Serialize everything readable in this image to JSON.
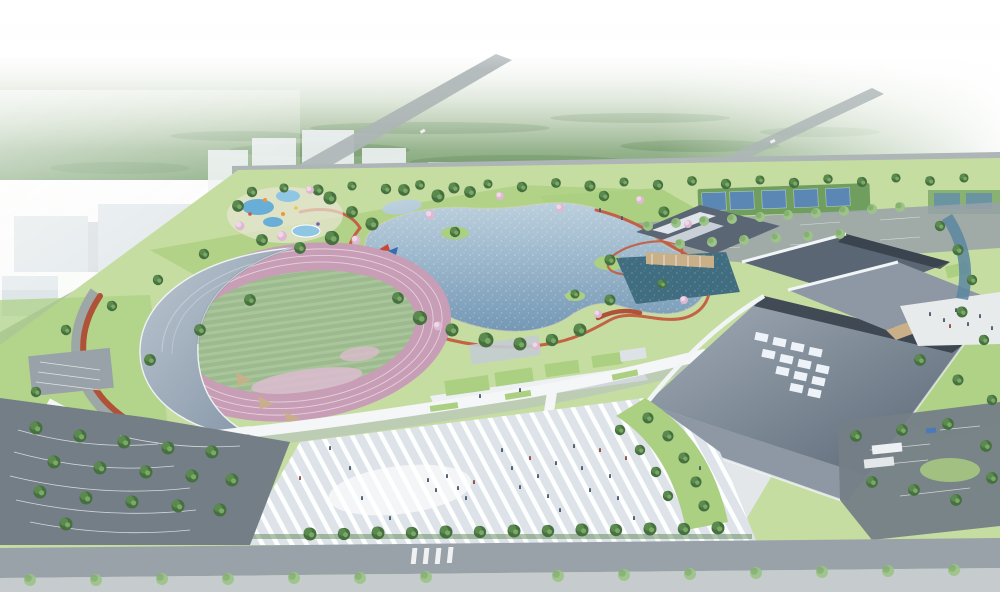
{
  "scene": {
    "kind": "aerial architectural rendering of a lakeside sports park",
    "elements": {
      "stadium": "crescent-roof grandstand with pink running track and green infield",
      "gymnasium": "large sweeping slate roof with diagonal white skylight grid",
      "natatorium": "overlapping swooping dark roofs with tan facades",
      "lake": "central sparkling lake with islands and red jogging loop",
      "plaza": "striped paved entry plaza with scattered visitors",
      "courts": "row of blue sport courts in green surround",
      "parking": "tree-lined parking lots southwest and southeast",
      "context": "hazy white city blocks and distant forest belt"
    }
  },
  "palette": {
    "sky": "#ffffff",
    "haze": "#f3f6f2",
    "forest_far": "#b9cbb0",
    "forest_near": "#7aa171",
    "forest_dark": "#5d8756",
    "tree_dark": "#46703f",
    "tree_mid": "#5d8b50",
    "tree_light": "#7fae69",
    "tree_pale": "#9cc488",
    "cherry": "#dfb8d2",
    "cherry_light": "#efd7e8",
    "lawn": "#c6dda2",
    "lawn_bright": "#abd081",
    "field_a": "#9cba8e",
    "field_b": "#a9c59b",
    "track": "#c79eb6",
    "track_light": "#d9bccd",
    "lane": "#ead9e4",
    "water_deep": "#6f94b2",
    "water_light": "#bdd1de",
    "pond": "#416d80",
    "canal": "#5b86a0",
    "roof_stand_a": "#7f90a3",
    "roof_stand_b": "#bcc7d1",
    "gym_a": "#5a6674",
    "gym_b": "#a2adb8",
    "gym_fold": "#8d98a4",
    "clerestory": "#323c46",
    "skylight": "#edf3f8",
    "eave": "#f2f5f7",
    "walkway": "#f4f6f7",
    "walkway_shadow": "#b4bec6",
    "plaza": "#dde3e9",
    "plaza_stripe": "#ffffff",
    "stairs": "#e3e7ea",
    "asphalt": "#747e87",
    "asphalt_light": "#99a2a9",
    "road": "#adb5b6",
    "red_path": "#c35b40",
    "red_dark": "#b05238",
    "court_blue": "#5b87b4",
    "court_green": "#6f9e5e",
    "tan": "#c9b089",
    "wood": "#b9986a",
    "city": "#dde4e8",
    "city_light": "#eef2f4",
    "pool_blue": "#69aed6",
    "pool_light": "#8fc6e4",
    "people": "#44566a",
    "people_warm": "#8a4a3a"
  }
}
